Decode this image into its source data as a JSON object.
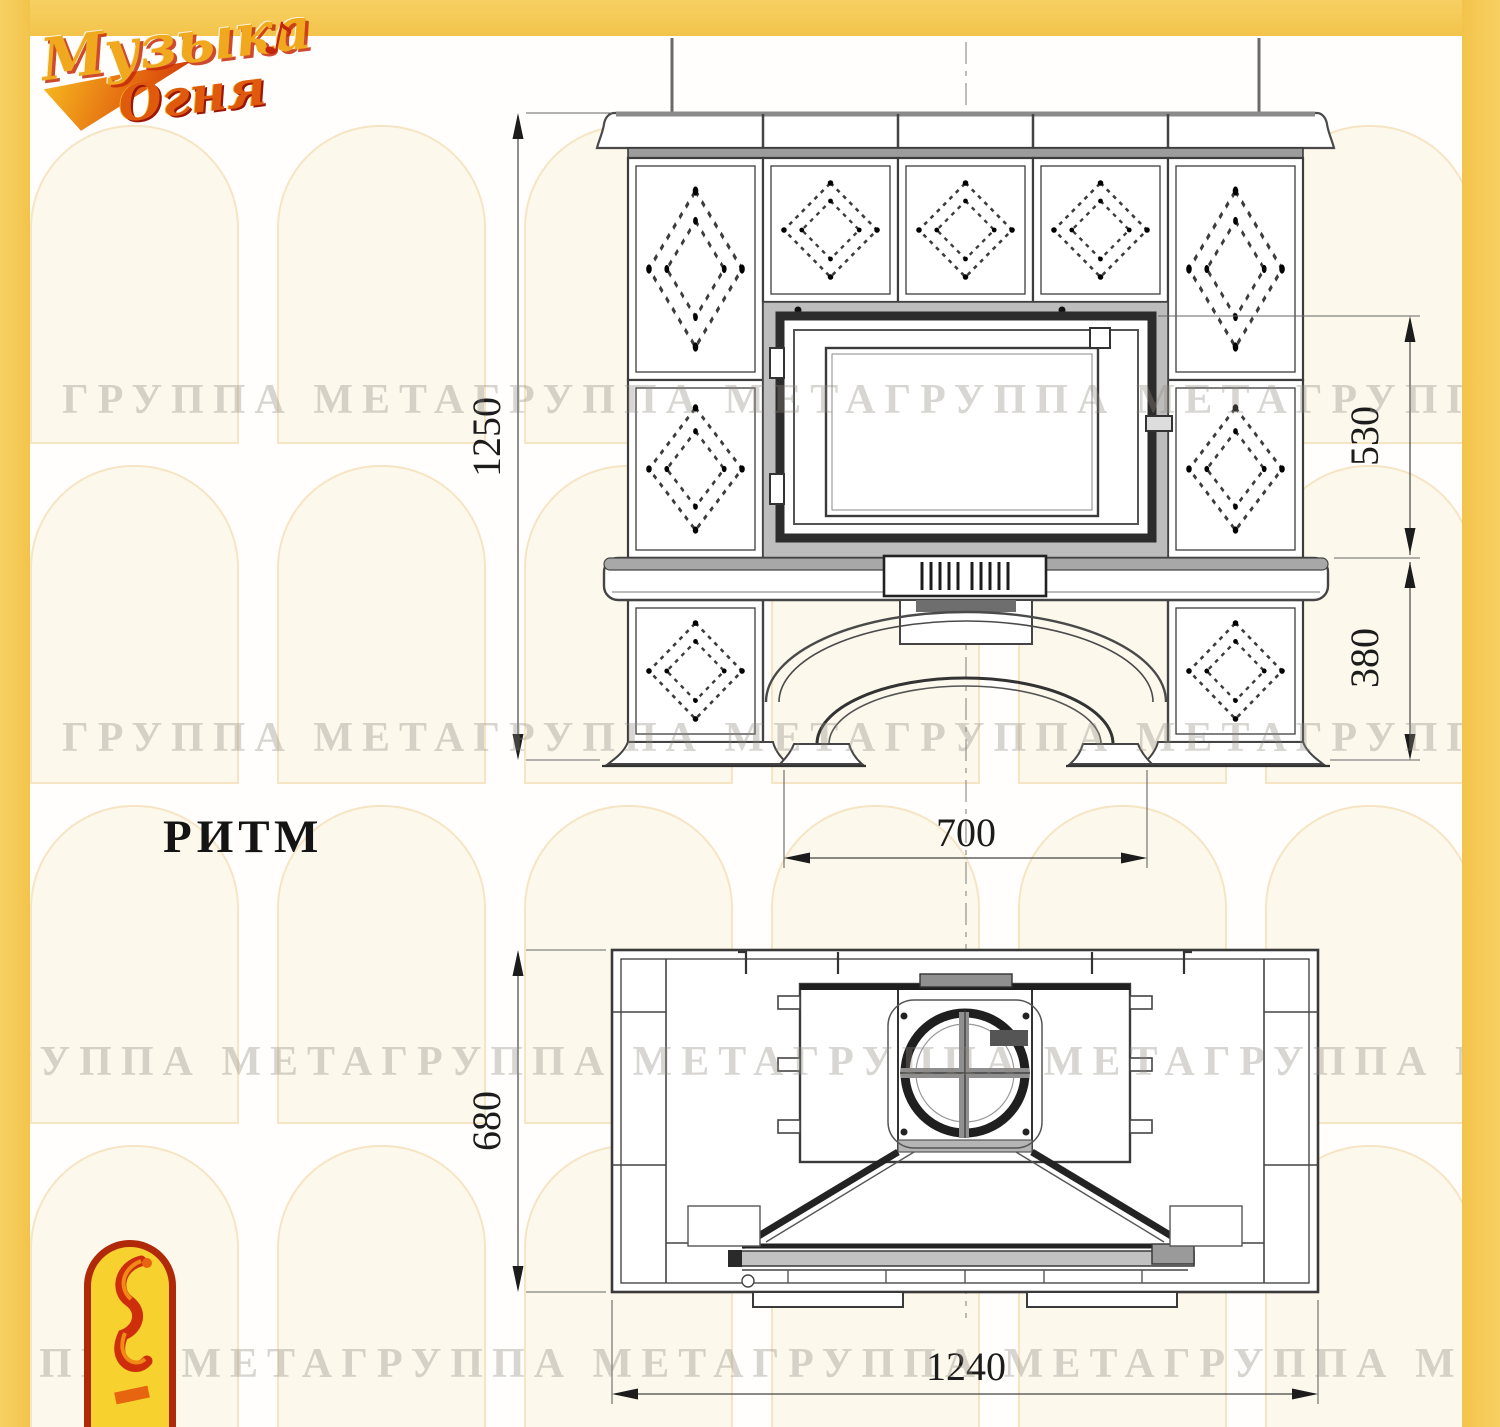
{
  "branding": {
    "logo_line1": "Музыка",
    "logo_line2": "Огня",
    "accent": "♪"
  },
  "model": {
    "name": "РИТМ"
  },
  "watermark": {
    "text": "ГРУППА МЕТАГРУППА МЕТАГРУППА МЕТАГРУППА МЕТАГРУППА МЕТА"
  },
  "colors": {
    "frame_yellow": "#f3c44b",
    "drawing_line": "#3a3a3a",
    "logo_gold": "#f0a81e",
    "logo_red": "#c3260c",
    "emblem_yellow": "#f7d22e",
    "emblem_border": "#b02909"
  },
  "front_view": {
    "dimensions": {
      "overall_height": "1250",
      "firebox_height": "530",
      "base_height": "380",
      "opening_width": "700"
    }
  },
  "plan_view": {
    "dimensions": {
      "depth": "680",
      "overall_width": "1240"
    }
  }
}
